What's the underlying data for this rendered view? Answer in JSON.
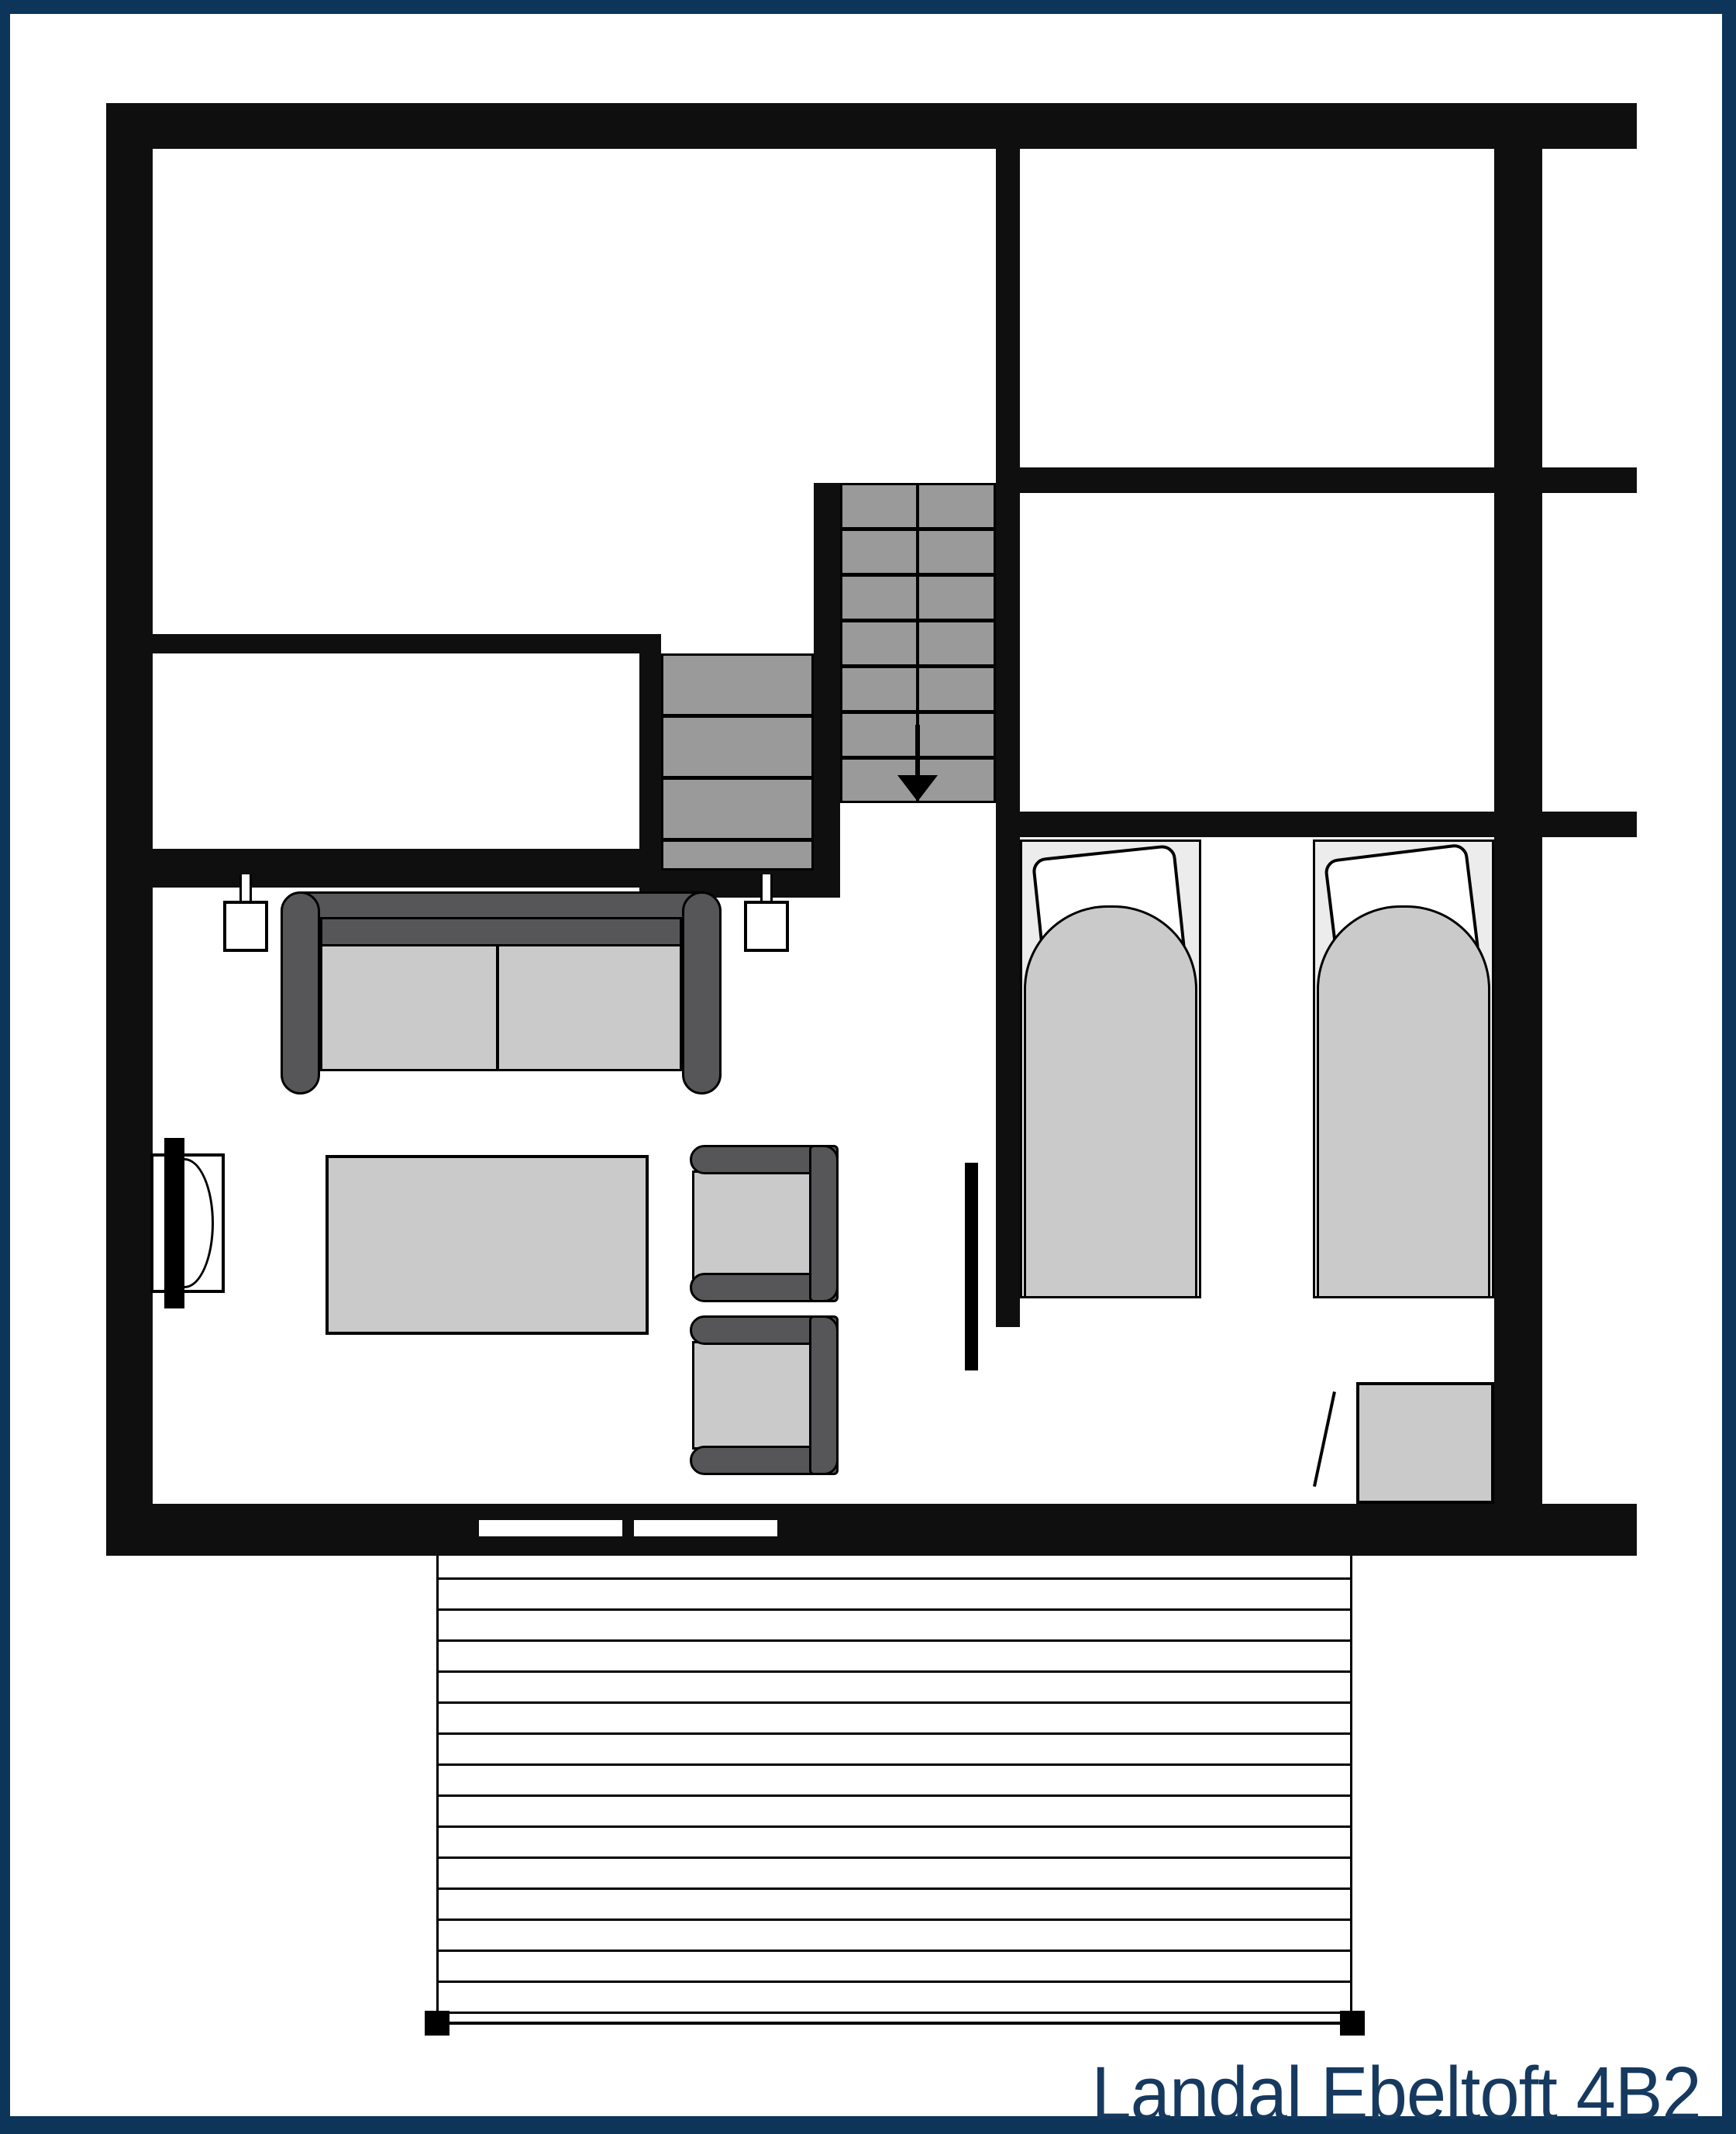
{
  "title": {
    "label": "Landal Ebeltoft 4B2",
    "color": "#16395f"
  },
  "frame": {
    "color": "#0d3459"
  },
  "palette": {
    "background": "#ffffff",
    "wall_black": "#0f0f0f",
    "stair_gray": "#9a9a9a",
    "furniture_dark_gray": "#565659",
    "furniture_light_gray": "#cacaca",
    "bed_base_gray": "#ececec",
    "outline_black": "#000000"
  },
  "floorplan": {
    "type": "cottage floor plan, top-down",
    "stairs": {
      "flights": 2,
      "upper_flight_treads": 7,
      "lower_flight_treads": 4,
      "direction_icon": "down-arrow"
    },
    "bedroom": {
      "beds": 2,
      "pillows_per_bed": 1,
      "cabinet": 1,
      "door_leaf": 1
    },
    "living_room": {
      "sofa_seats": 2,
      "wall_lamps": 2,
      "tv_unit": 1,
      "coffee_table": 1,
      "armchairs": 2,
      "radiator": 1
    },
    "bottom_wall_window_slots": 2,
    "deck": {
      "plank_line_spacing_px": 40,
      "corner_markers": 2
    }
  }
}
